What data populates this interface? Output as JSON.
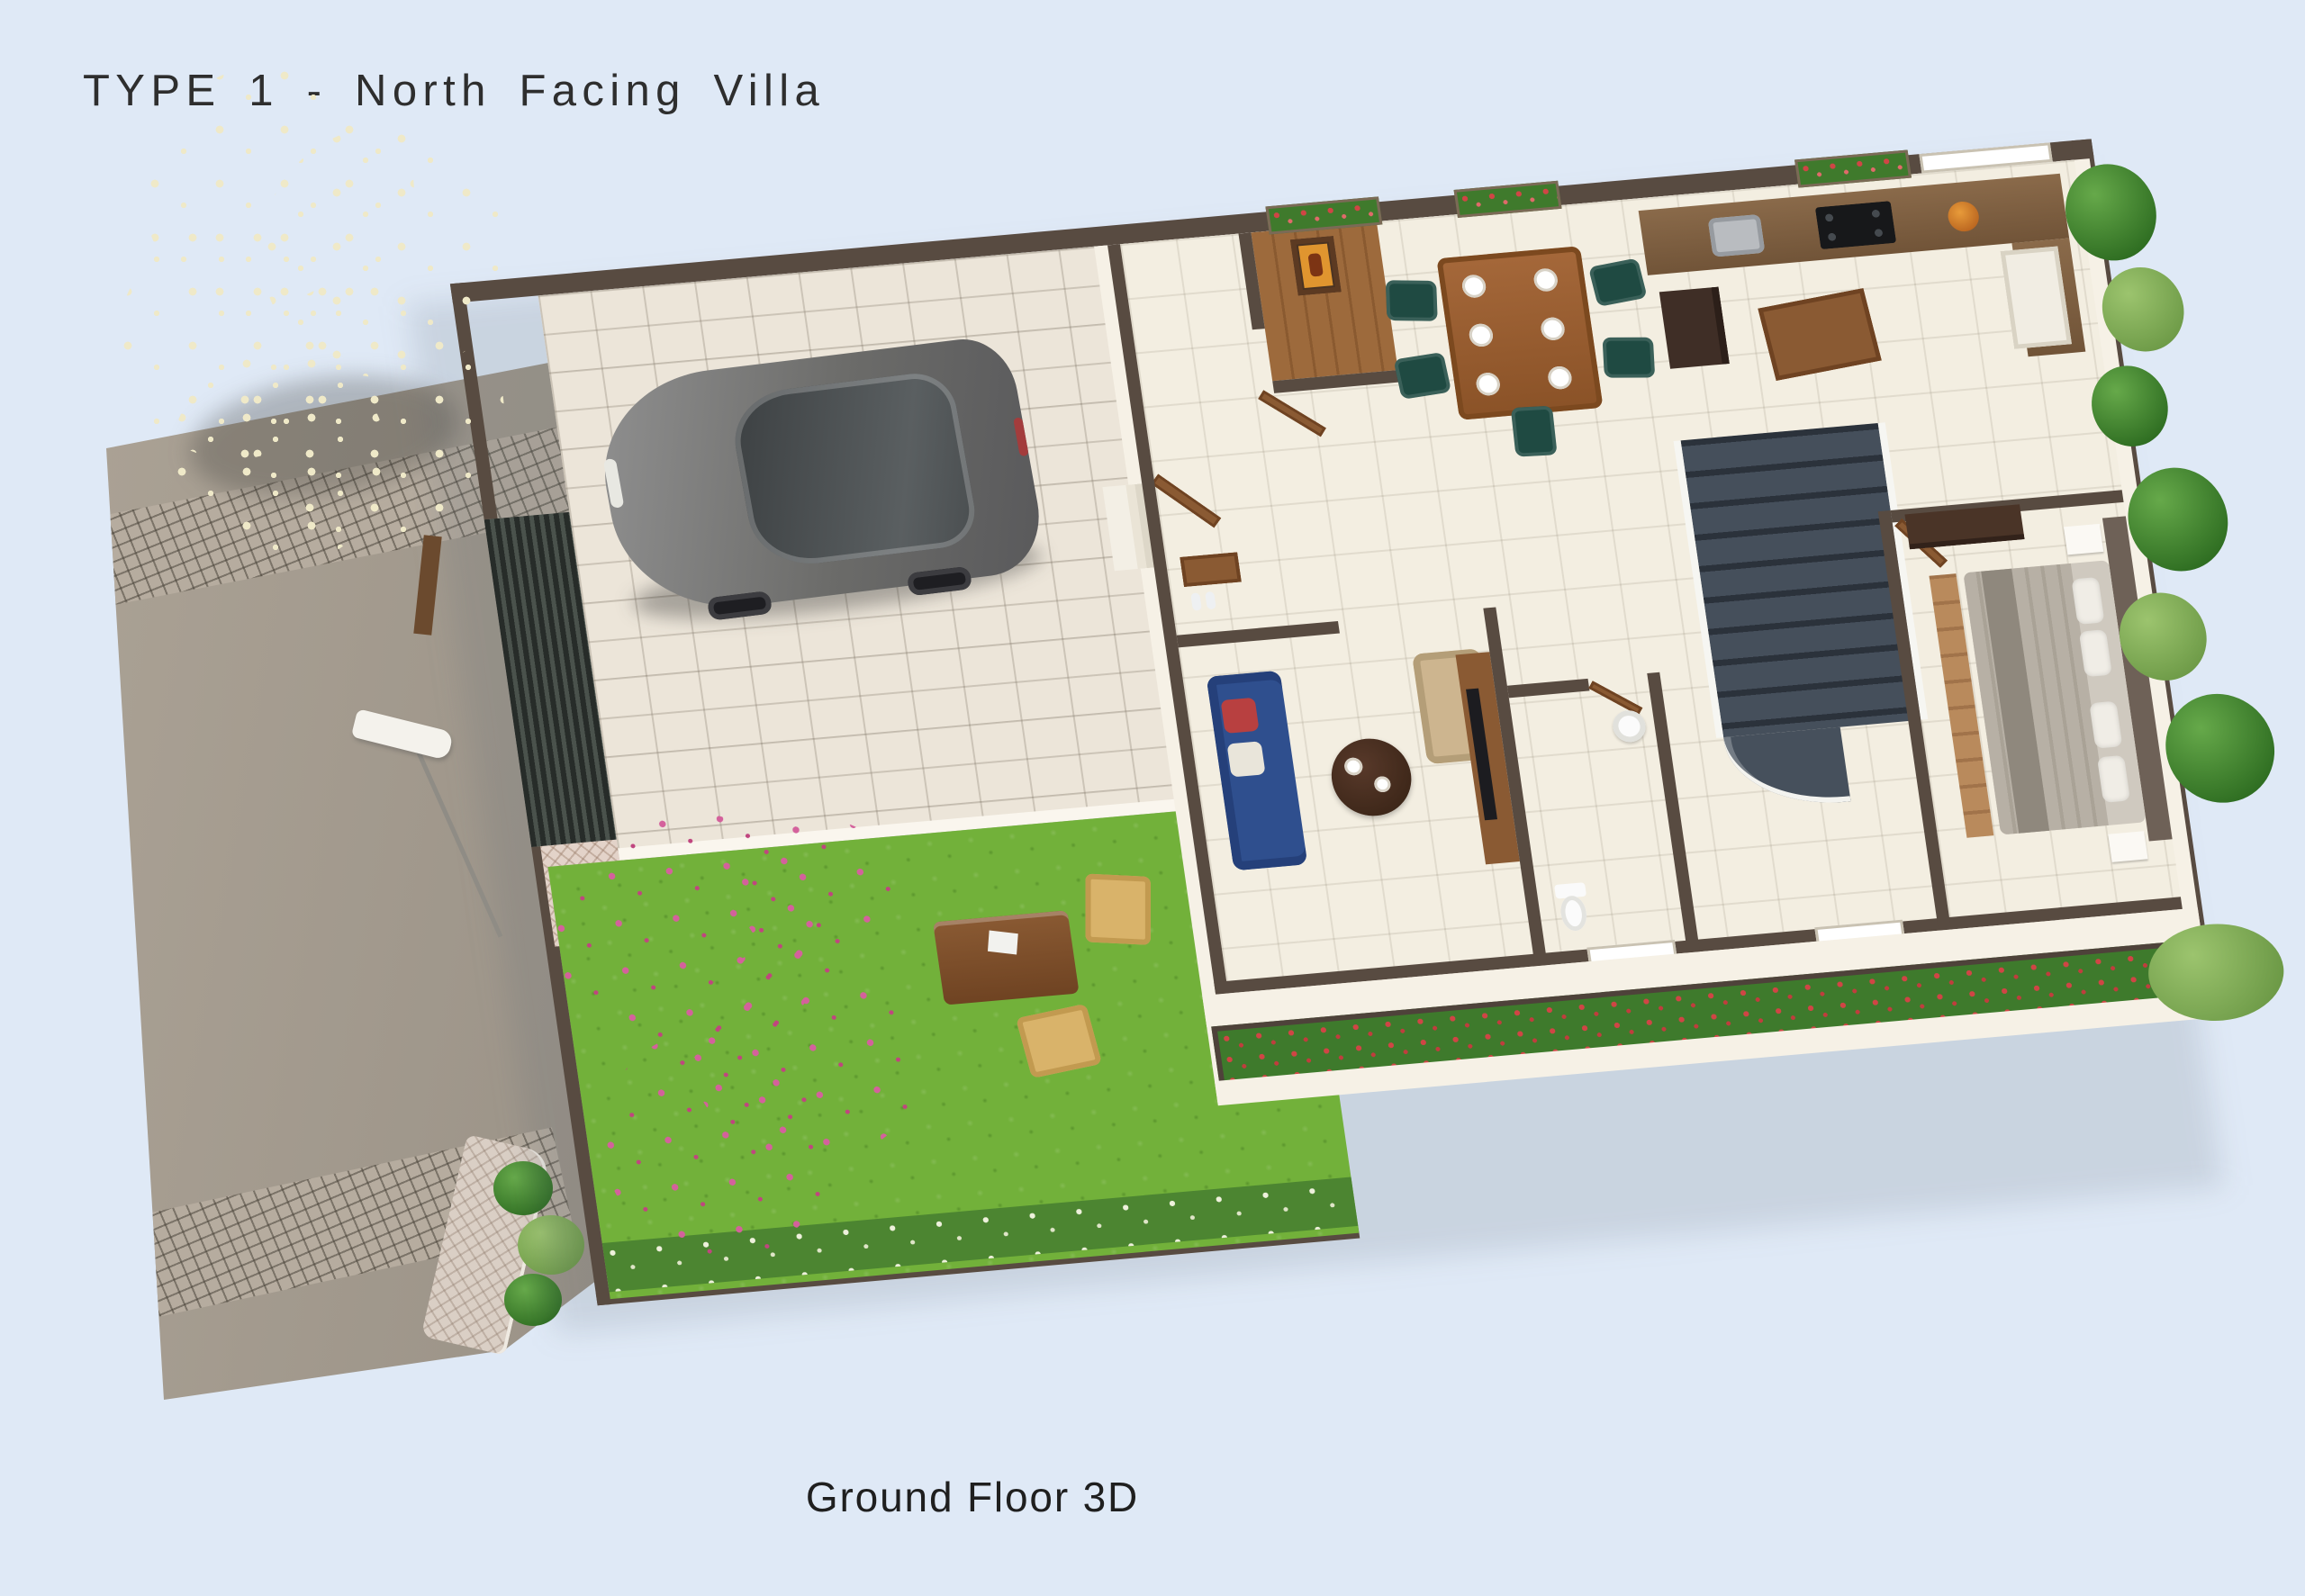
{
  "title": "TYPE 1 - North Facing Villa",
  "caption": "Ground Floor 3D",
  "colors": {
    "bg": "#dfe9f6",
    "ink": "#2e2e2e",
    "road": "#a59d92",
    "cobble": "#b6ac9f",
    "sidewalk": "#dacfc5",
    "lawn": "#72b13a",
    "lawn_dark": "#4c8531",
    "paver": "#ece5d9",
    "plinth": "#f6f1e6",
    "floor": "#f3eee1",
    "wall": "#584b41",
    "wood": "#9a5c2e",
    "wood_dark": "#6f4322",
    "gate": "#3a403c",
    "sofa_blue": "#2f4f8e",
    "cushion_red": "#b84040",
    "armchair_beige": "#cdb58f",
    "chair_teal": "#1f4a42",
    "stair": "#39414d",
    "bed_gray": "#b7b0a5",
    "pillow": "#f0ede6",
    "leaf": "#4e9033",
    "leaf_dark": "#2f6e22",
    "blossom": "#efe9c8",
    "flower_red": "#d04545",
    "flower_pink": "#d4619c",
    "car_gray": "#767674",
    "lamp_white": "#f4f2ec"
  },
  "scene": {
    "view": "isometric-3d-ground-floor-plan-of-villa",
    "outdoor": {
      "road": {
        "surface": "asphalt",
        "cobble_crossings": 2,
        "sidewalk": "herringbone pavers"
      },
      "street_lamp": "white-head lamp on leaning pole",
      "flowering_tree": "large canopy with white blossoms at top-left",
      "driveway_gate": "dark slatted gate",
      "car": {
        "type": "sedan",
        "color": "dark gray",
        "parked_on": "paver car porch"
      },
      "garden": {
        "lawn": true,
        "outdoor_table": 1,
        "outdoor_chairs": 2,
        "pink_flower_shrub": true,
        "white_flower_border": true
      },
      "red_flower_bed": "planter strip along front wall",
      "window_flower_boxes": 3,
      "right_side_plants": "climbing greens and trees along east wall"
    },
    "rooms": [
      {
        "name": "Car Porch",
        "items": [
          "car",
          "paver tiles"
        ]
      },
      {
        "name": "Garden",
        "items": [
          "lawn",
          "outdoor table",
          "2 chairs",
          "flower shrub"
        ]
      },
      {
        "name": "Foyer",
        "items": [
          "open main door",
          "bench with shoes",
          "entry steps"
        ]
      },
      {
        "name": "Pooja Room",
        "items": [
          "deity frame",
          "wood floor"
        ]
      },
      {
        "name": "Living Room",
        "items": [
          "blue 3-seat sofa",
          "round coffee table",
          "beige armchair",
          "TV unit"
        ]
      },
      {
        "name": "Toilet",
        "items": [
          "WC",
          "wash basin"
        ]
      },
      {
        "name": "Dining",
        "items": [
          "wooden 6-seat table",
          "dark green chairs",
          "plates"
        ]
      },
      {
        "name": "Kitchen",
        "items": [
          "L-shaped counter",
          "hob",
          "sink",
          "fridge",
          "island cabinet",
          "tall cabinet",
          "fruit bowl"
        ]
      },
      {
        "name": "Staircase",
        "items": [
          "dark carpeted steps",
          "white railing",
          "quarter-turn landing"
        ]
      },
      {
        "name": "Bedroom",
        "items": [
          "double bed",
          "pillows",
          "wardrobe",
          "bedside tables",
          "wood runner",
          "accent wall"
        ]
      }
    ]
  }
}
